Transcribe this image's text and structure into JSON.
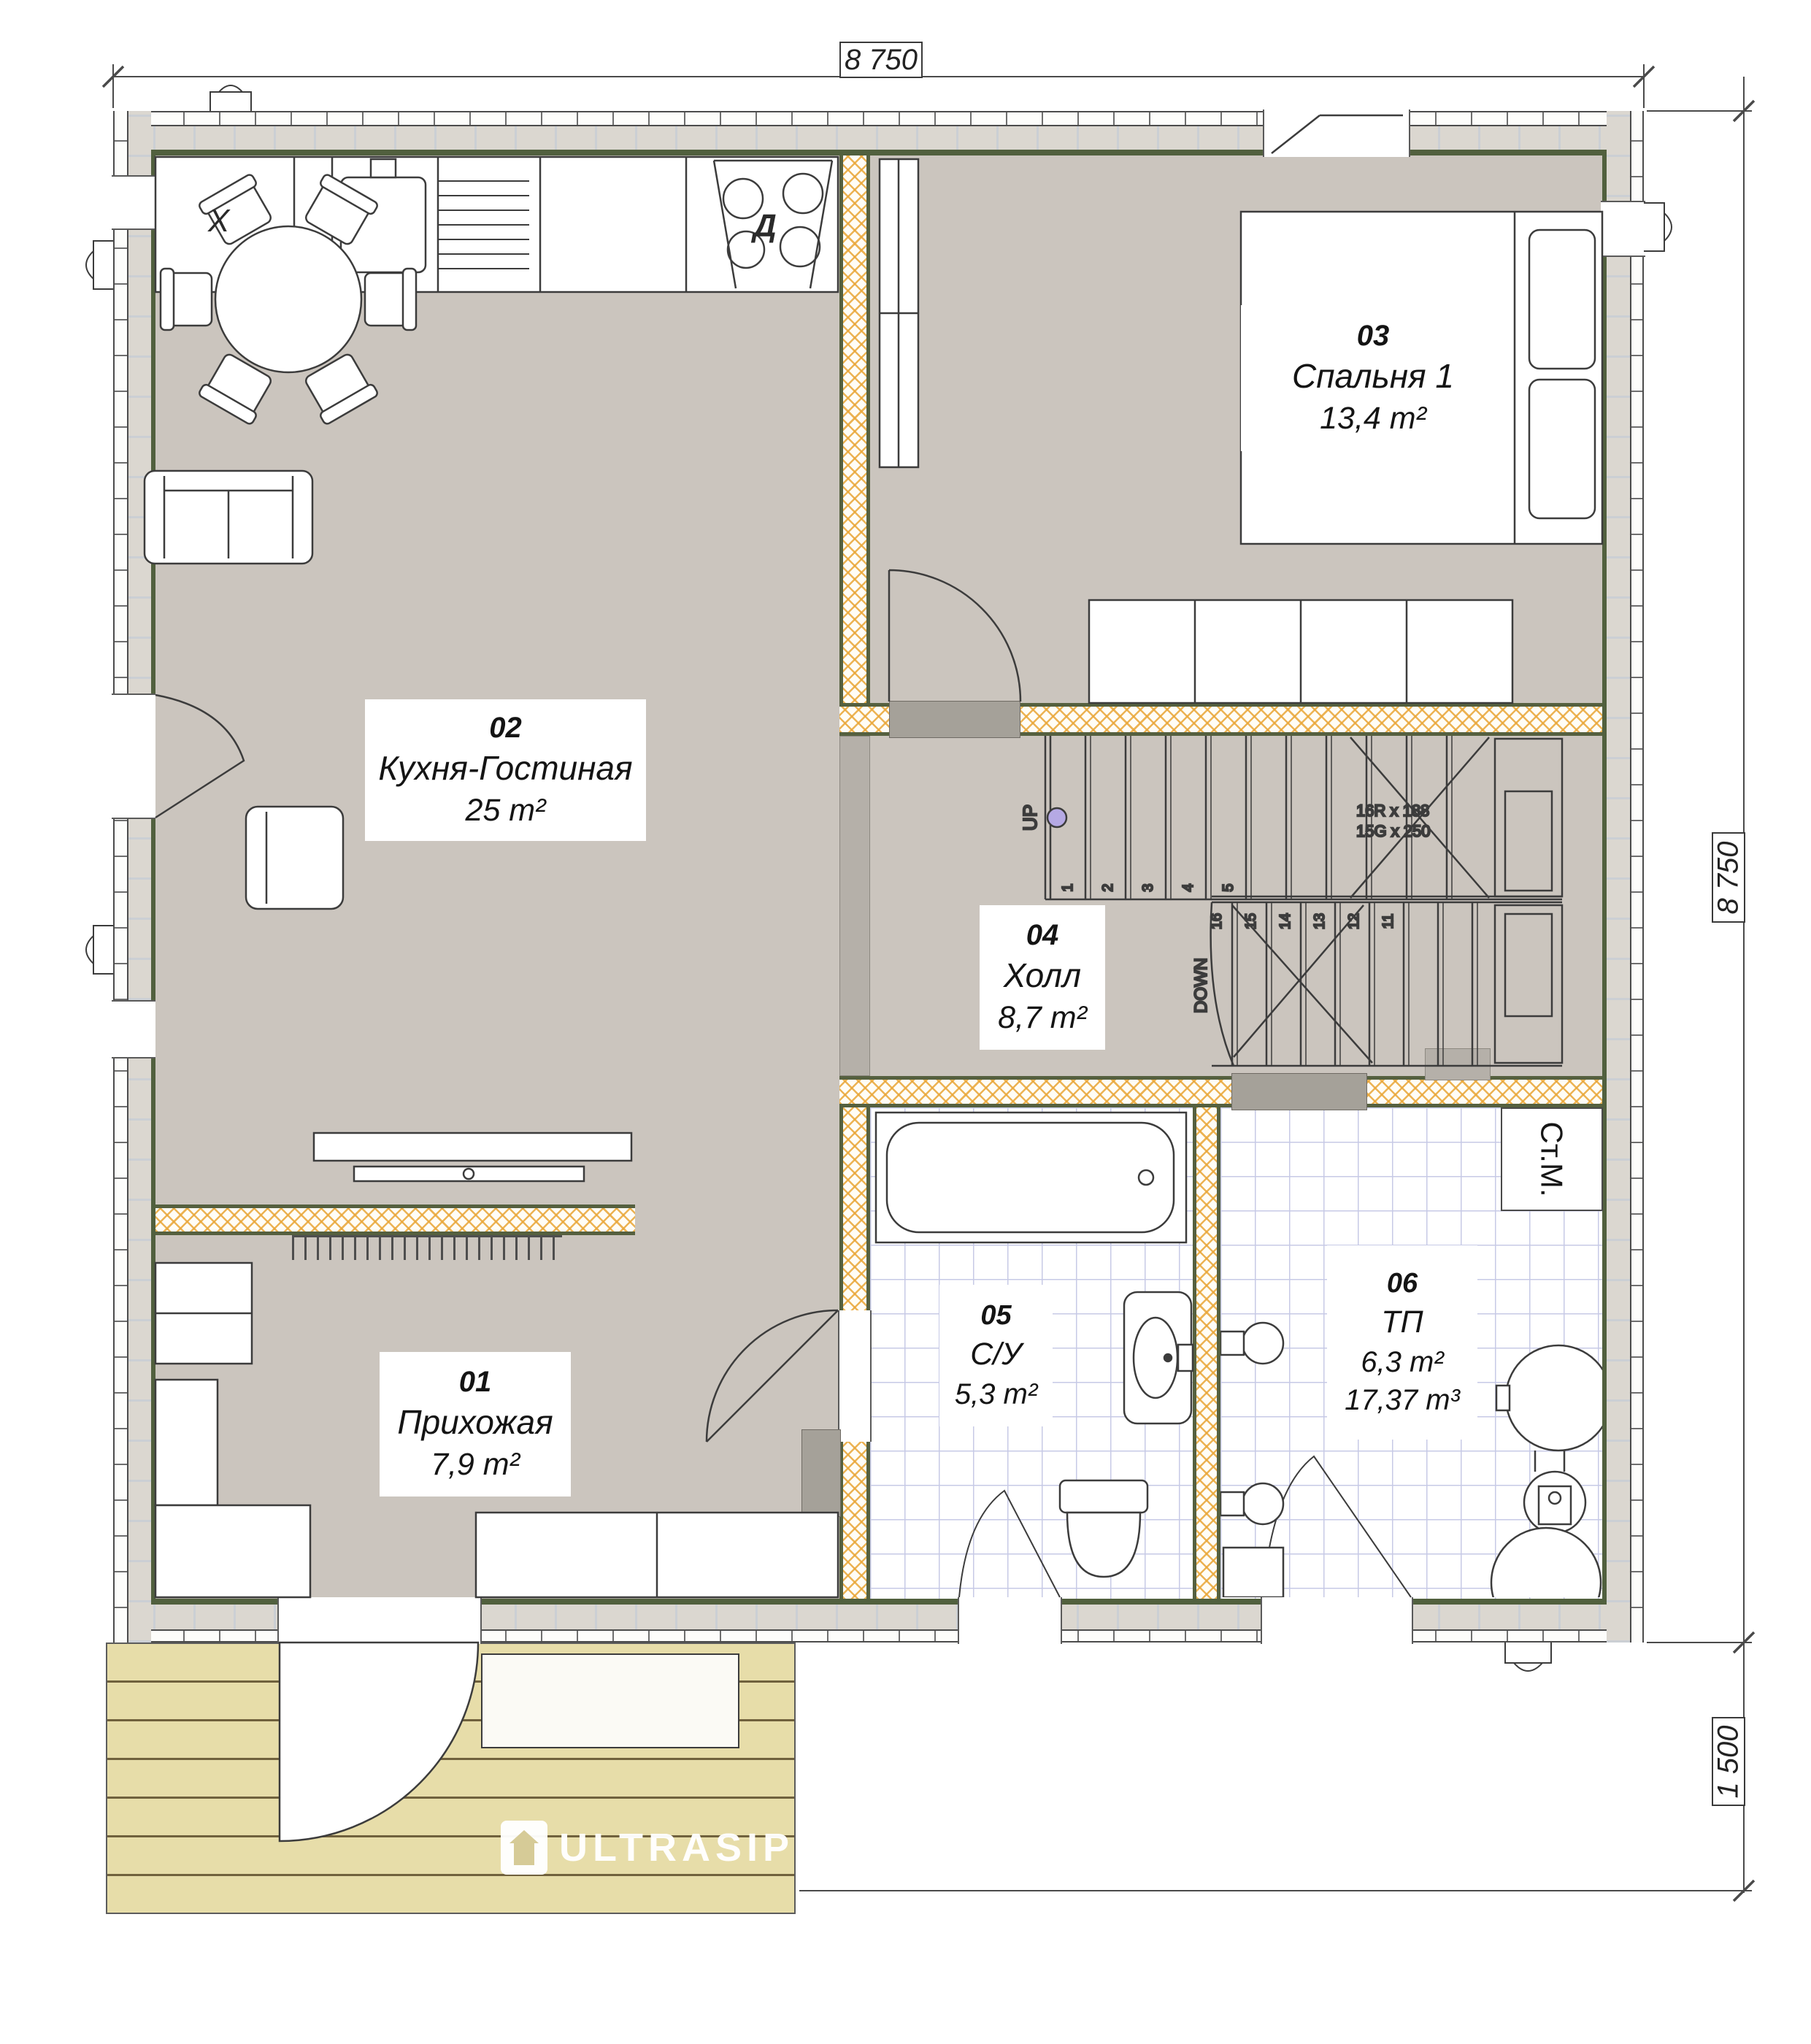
{
  "dimensions": {
    "top": "8 750",
    "right_upper": "8 750",
    "right_lower": "1 500"
  },
  "rooms": [
    {
      "number": "01",
      "name": "Прихожая",
      "area": "7,9 m²"
    },
    {
      "number": "02",
      "name": "Кухня-Гостиная",
      "area": "25 m²"
    },
    {
      "number": "03",
      "name": "Спальня 1",
      "area": "13,4 m²"
    },
    {
      "number": "04",
      "name": "Холл",
      "area": "8,7 m²"
    },
    {
      "number": "05",
      "name": "С/У",
      "area": "5,3 m²"
    },
    {
      "number": "06",
      "name": "ТП",
      "area": "6,3 m²",
      "volume": "17,37 m³"
    }
  ],
  "appliances": {
    "washing_machine": "Ст.М.",
    "fridge": "X",
    "stove": "Д"
  },
  "stairs": {
    "up_label": "UP",
    "down_label": "DOWN",
    "riser_note": "16R x 188",
    "going_note": "15G x 250",
    "up_numbers": [
      "1",
      "2",
      "3",
      "4",
      "5"
    ],
    "down_numbers": [
      "16",
      "15",
      "14",
      "13",
      "12",
      "11"
    ]
  },
  "branding": {
    "logo": "ULTRASIP"
  },
  "colors": {
    "floor_gray": "#cbc5be",
    "wall_fill": "#dbd7d0",
    "inner_wall_line": "#51603e",
    "insulation": "#e9a637",
    "tile_line": "#c7cae6",
    "deck_plank": "#e7dda9",
    "up_dot": "#b5a9e4"
  }
}
